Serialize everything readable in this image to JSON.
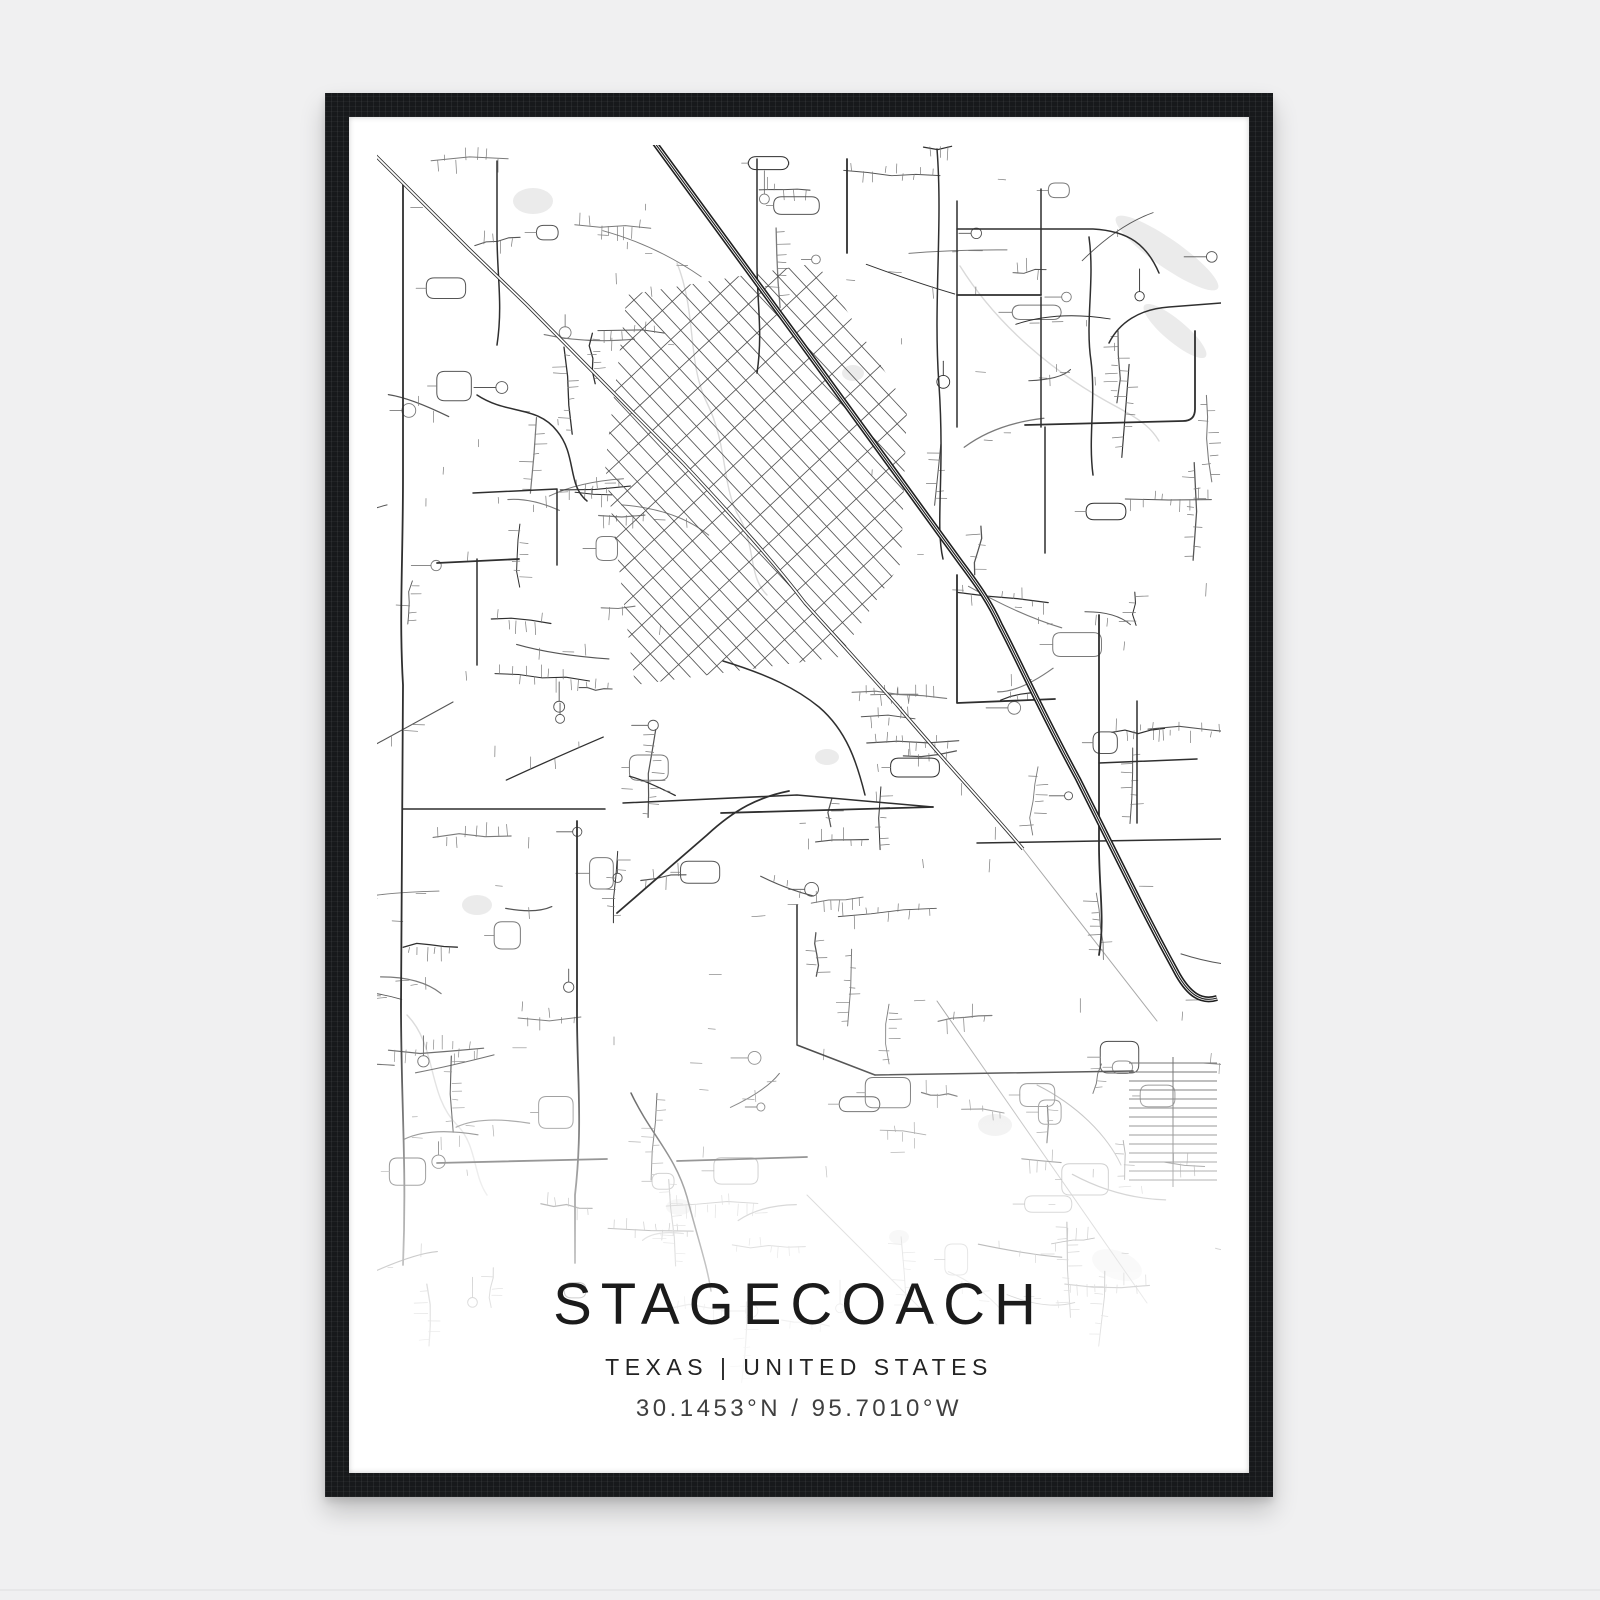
{
  "poster": {
    "title": "STAGECOACH",
    "subtitle": "TEXAS | UNITED STATES",
    "coordinates": "30.1453°N / 95.7010°W"
  },
  "colors": {
    "page_bg": "#f0f0f1",
    "frame": "#17191b",
    "poster_bg": "#ffffff",
    "road_dark": "#2f2f2f",
    "road_mid": "#555555",
    "road_minor": "#7a7a7a",
    "road_faint": "#a8a8a8",
    "creek": "#d9d9d9",
    "water": "#ebebeb",
    "highway": "#1f1f1f",
    "railway": "#2e2e2e",
    "text_primary": "#1b1b1b",
    "text_secondary": "#3f3f3f"
  },
  "map": {
    "seed": 1337,
    "width": 844,
    "height": 1240,
    "fade_start": 860,
    "parks": [
      [
        156,
        56,
        20,
        13,
        0
      ],
      [
        790,
        108,
        62,
        14,
        35
      ],
      [
        798,
        186,
        40,
        11,
        40
      ],
      [
        476,
        228,
        11,
        8,
        0
      ],
      [
        100,
        760,
        15,
        10,
        0
      ],
      [
        450,
        612,
        12,
        8,
        0
      ],
      [
        618,
        980,
        17,
        11,
        0
      ],
      [
        302,
        1062,
        13,
        8,
        0
      ],
      [
        740,
        1120,
        26,
        14,
        20
      ],
      [
        522,
        1092,
        10,
        7,
        0
      ]
    ],
    "creeks": [
      "M583,121 C620,180 676,228 740,262 C766,276 775,284 782,296",
      "M300,118 C320,168 310,218 330,258 C350,298 345,338 360,368",
      "M360,368 C380,400 370,430 390,450",
      "M30,870 C60,900 50,950 80,980 C100,1000 96,1030 110,1050"
    ],
    "faint_roads": [
      "M646,704 L780,876",
      "M560,856 L770,1158",
      "M430,1050 L560,1180",
      "M660,940 C700,960 730,990 744,1020"
    ],
    "collectors": [
      "M26,40 L26,330 C26,420 22,470 26,540 L24,860 C24,960 30,1020 26,1120",
      "M26,664 L228,664",
      "M246,658 L420,650 L556,662",
      "M200,676 L200,870 C200,930 206,980 198,1050 L198,1118",
      "M580,56 L580,282",
      "M580,84 L716,84 C752,86 770,100 782,128",
      "M580,150 L664,150",
      "M664,150 L664,44",
      "M664,152 L664,282",
      "M648,280 L806,276 Q818,276 818,264 L818,186",
      "M668,282 L668,408",
      "M712,92 C718,136 708,176 714,216 C719,256 711,292 716,330",
      "M722,470 L722,700 C722,745 728,775 722,810",
      "M600,698 L844,694",
      "M254,948 C274,990 298,1010 310,1052 C322,1098 330,1120 334,1146",
      "M60,1018 L230,1014",
      "M498,930 L756,926",
      "M346,516 C392,530 420,544 442,562 C470,586 480,618 488,650",
      "M344,668 L556,662",
      "M100,250 C130,270 160,260 180,286 C200,310 190,340 210,356",
      "M120,16 L120,90 C120,130 126,160 120,200",
      "M470,14 L470,108",
      "M380,14 L380,118 C380,158 386,188 380,228",
      "M844,158 L792,162 C762,164 742,178 732,198",
      "M580,430 L580,558 L678,554",
      "M760,556 L760,678",
      "M722,618 L820,614",
      "M60,418 L142,414",
      "M100,414 L100,520",
      "M560,4 C566,80 556,160 562,240 C568,330 558,380 566,414",
      "M240,768 L330,690 C358,664 382,652 412,646",
      "M96,348 L180,344 L180,420",
      "M420,760 L420,900 L498,930",
      "M300,1016 L430,1012"
    ],
    "railway": "M-8,4 L92,104 L150,160 L306,318 C360,376 396,416 428,458 L520,560 C560,608 600,650 646,704",
    "highway": "M272,-10 L430,206 L584,418 C602,442 613,458 623,480 C642,516 662,562 701,634 L758,748 C774,780 790,810 801,830 C812,849 824,858 840,853",
    "hatch": {
      "polygon": [
        [
          250,
          150
        ],
        [
          440,
          118
        ],
        [
          530,
          262
        ],
        [
          524,
          418
        ],
        [
          462,
          512
        ],
        [
          258,
          540
        ],
        [
          228,
          320
        ]
      ],
      "families": [
        {
          "angle": 47,
          "spacing": 13.5
        },
        {
          "angle": -43,
          "spacing": 27
        }
      ]
    },
    "ladder": {
      "x1": 752,
      "x2": 840,
      "trunk_x": 796,
      "y1": 918,
      "y2": 1038,
      "step": 9
    },
    "zones": [
      {
        "x": [
          8,
          232
        ],
        "y": [
          14,
          640
        ],
        "n": 30,
        "faint": false
      },
      {
        "x": [
          8,
          232
        ],
        "y": [
          640,
          1150
        ],
        "n": 28,
        "faint": false
      },
      {
        "x": [
          236,
          556
        ],
        "y": [
          540,
          1010
        ],
        "n": 32,
        "faint": false
      },
      {
        "x": [
          236,
          556
        ],
        "y": [
          0,
          140
        ],
        "n": 10,
        "faint": false
      },
      {
        "x": [
          180,
          252
        ],
        "y": [
          150,
          540
        ],
        "n": 6,
        "faint": false
      },
      {
        "x": [
          560,
          840
        ],
        "y": [
          8,
          300
        ],
        "n": 16,
        "faint": false
      },
      {
        "x": [
          560,
          840
        ],
        "y": [
          300,
          700
        ],
        "n": 18,
        "faint": false
      },
      {
        "x": [
          560,
          840
        ],
        "y": [
          700,
          1160
        ],
        "n": 22,
        "faint": false
      },
      {
        "x": [
          236,
          700
        ],
        "y": [
          1010,
          1180
        ],
        "n": 18,
        "faint": true
      }
    ],
    "stub_count": 70
  }
}
